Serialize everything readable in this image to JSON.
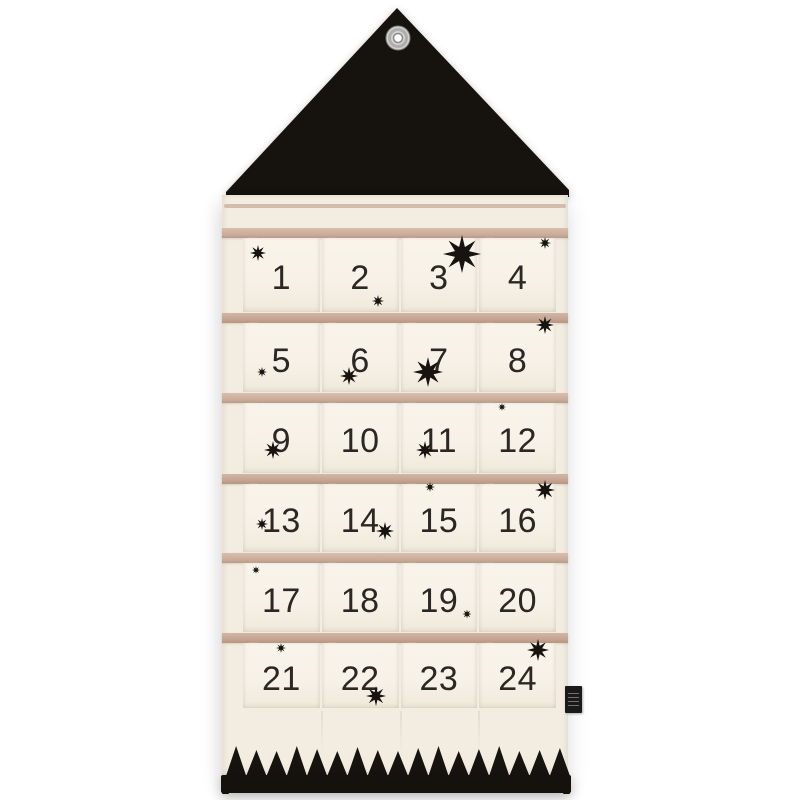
{
  "scene": {
    "description": "House-shaped fabric advent calendar wall hanging with black triangular roof, metal grommet, 24 cream pockets with black numbers, scattered black eight-pointed stars, black zigzag trim and black hanging bar at the bottom, small black brand tag on the right edge"
  },
  "calendar": {
    "rows": 6,
    "columns": 4,
    "pocket_numbers": [
      "1",
      "2",
      "3",
      "4",
      "5",
      "6",
      "7",
      "8",
      "9",
      "10",
      "11",
      "12",
      "13",
      "14",
      "15",
      "16",
      "17",
      "18",
      "19",
      "20",
      "21",
      "22",
      "23",
      "24"
    ]
  },
  "colors": {
    "background": "#ffffff",
    "roof": "#16120e",
    "fabric": "#f3ede1",
    "pocket": "#f7f2e8",
    "trim": "#c9ab99",
    "number": "#2b2723",
    "star": "#17130f",
    "zigzag": "#17130f",
    "bar": "#15110d",
    "grommet_ring": "#d2d2d2"
  },
  "stars": [
    {
      "x": 258,
      "y": 253,
      "size": 16
    },
    {
      "x": 462,
      "y": 254,
      "size": 38
    },
    {
      "x": 545,
      "y": 243,
      "size": 12
    },
    {
      "x": 378,
      "y": 301,
      "size": 12
    },
    {
      "x": 262,
      "y": 372,
      "size": 10
    },
    {
      "x": 349,
      "y": 376,
      "size": 18
    },
    {
      "x": 428,
      "y": 372,
      "size": 30
    },
    {
      "x": 545,
      "y": 325,
      "size": 18
    },
    {
      "x": 273,
      "y": 450,
      "size": 18
    },
    {
      "x": 425,
      "y": 450,
      "size": 18
    },
    {
      "x": 502,
      "y": 407,
      "size": 8
    },
    {
      "x": 262,
      "y": 524,
      "size": 12
    },
    {
      "x": 385,
      "y": 531,
      "size": 18
    },
    {
      "x": 430,
      "y": 487,
      "size": 10
    },
    {
      "x": 545,
      "y": 490,
      "size": 20
    },
    {
      "x": 256,
      "y": 570,
      "size": 8
    },
    {
      "x": 467,
      "y": 614,
      "size": 9
    },
    {
      "x": 281,
      "y": 648,
      "size": 10
    },
    {
      "x": 376,
      "y": 696,
      "size": 20
    },
    {
      "x": 538,
      "y": 650,
      "size": 22
    }
  ],
  "zigzag": {
    "teeth": 17,
    "heights": [
      30,
      26,
      25,
      30,
      27,
      25,
      29,
      26,
      25,
      28,
      30,
      25,
      27,
      30,
      25,
      26,
      28
    ]
  }
}
